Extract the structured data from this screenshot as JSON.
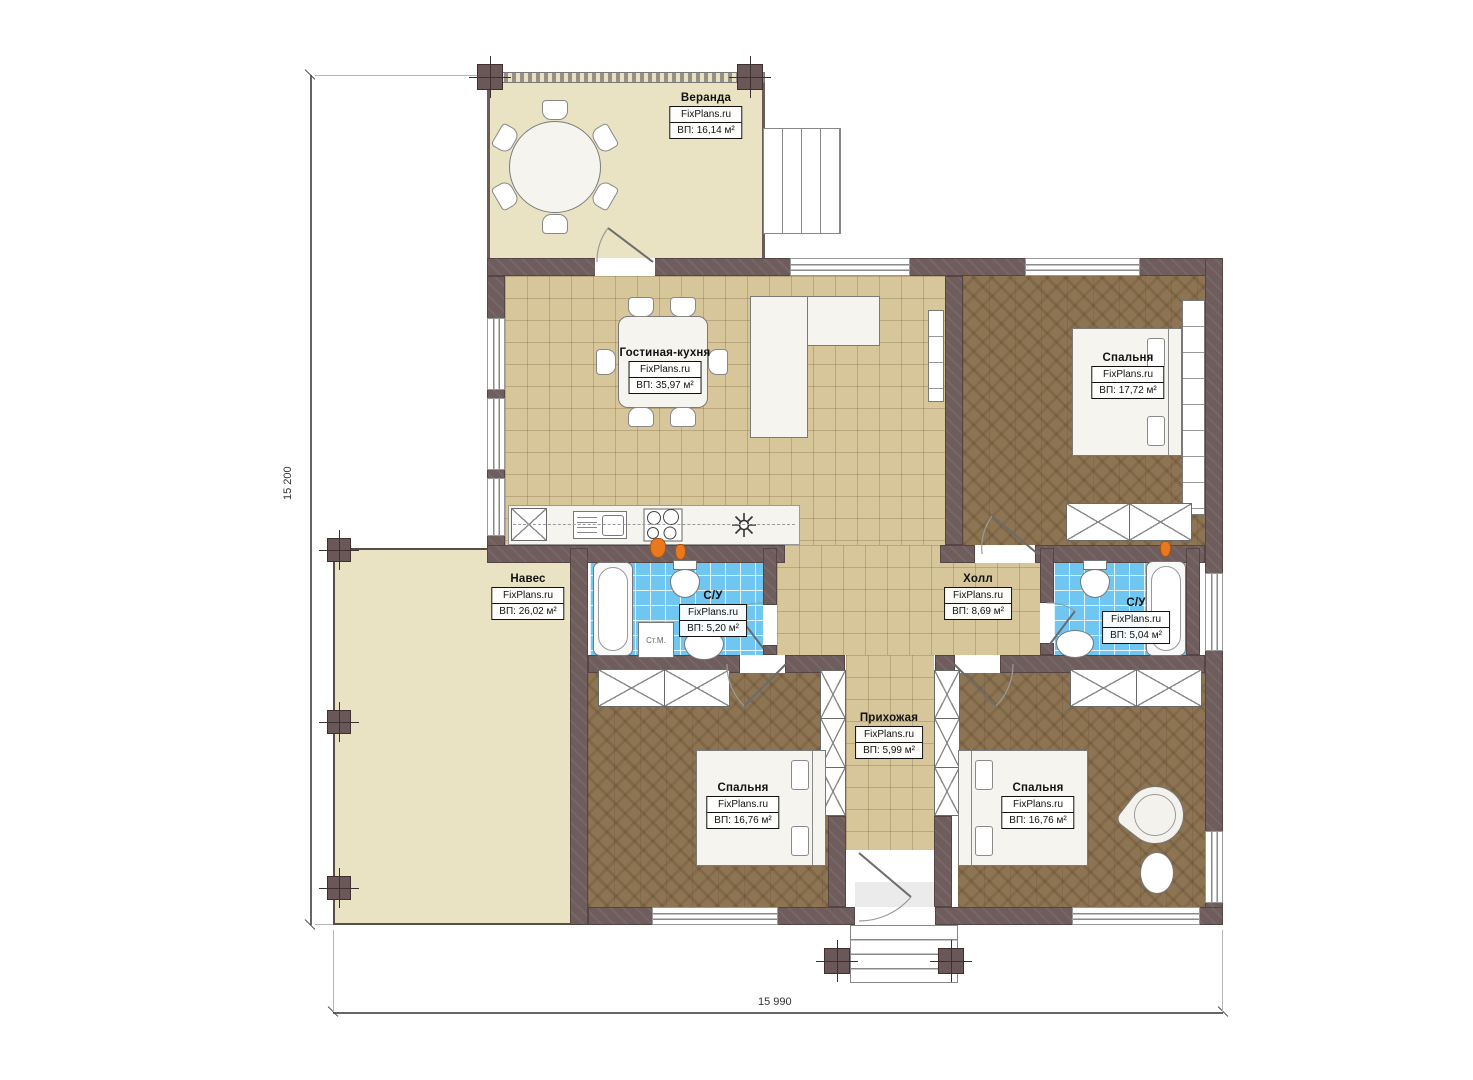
{
  "plan": {
    "brand": "FixPlans.ru",
    "rooms": {
      "veranda": {
        "name": "Веранда",
        "area": "ВП: 16,14 м²"
      },
      "living": {
        "name": "Гостиная-кухня",
        "area": "ВП: 35,97 м²"
      },
      "bedroom_top": {
        "name": "Спальня",
        "area": "ВП: 17,72 м²"
      },
      "canopy": {
        "name": "Навес",
        "area": "ВП: 26,02 м²"
      },
      "bath_left": {
        "name": "С/У",
        "area": "ВП: 5,20 м²"
      },
      "hall": {
        "name": "Холл",
        "area": "ВП: 8,69 м²"
      },
      "bath_right": {
        "name": "С/У",
        "area": "ВП: 5,04 м²"
      },
      "entry": {
        "name": "Прихожая",
        "area": "ВП: 5,99 м²"
      },
      "bedroom_left": {
        "name": "Спальня",
        "area": "ВП: 16,76 м²"
      },
      "bedroom_right": {
        "name": "Спальня",
        "area": "ВП: 16,76 м²"
      }
    },
    "annotations": {
      "washing_machine": "Ст.М."
    },
    "dimensions": {
      "height": "15 200",
      "width": "15 990"
    },
    "colors": {
      "wall": "#6f5d5d",
      "tile_tan": "#d8c69b",
      "tile_blue": "#6fc6f0",
      "wood": "#8d7453",
      "outdoor": "#e9e3c3",
      "accent_orange": "#e8791e"
    }
  }
}
